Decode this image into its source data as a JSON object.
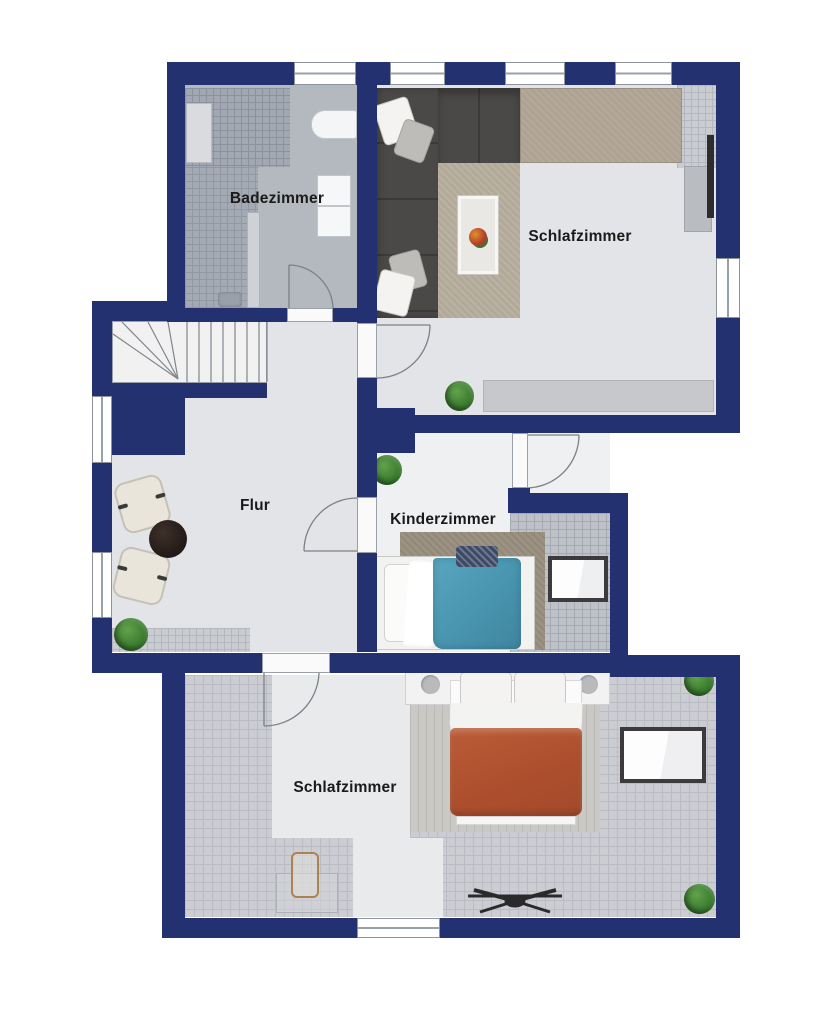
{
  "floorplan": {
    "title": "Obergeschoss Grundriss",
    "rooms": [
      {
        "id": "badezimmer",
        "label": "Badezimmer"
      },
      {
        "id": "schlafzimmer-top",
        "label": "Schlafzimmer"
      },
      {
        "id": "flur",
        "label": "Flur"
      },
      {
        "id": "kinderzimmer",
        "label": "Kinderzimmer"
      },
      {
        "id": "schlafzimmer-bottom",
        "label": "Schlafzimmer"
      }
    ],
    "colors": {
      "wall": "#243170",
      "floor_light": "#e2e4e7",
      "tile_light": "#cccdd2",
      "tile_shower": "#a2a8b2",
      "rug_beige": "#b2a998",
      "rug_brown": "#9c9282",
      "rug_gray": "#cac9c5",
      "duvet_teal": "#4d9cb8",
      "duvet_terracotta": "#b0532f",
      "sofa_gray": "#4b4947",
      "plant_green": "#3f7d33"
    },
    "counts": {
      "windows": 8,
      "doors": 5,
      "skylights": 2,
      "plants": 5
    },
    "furniture": [
      "corner-sofa",
      "coffee-tray",
      "wardrobe",
      "tv",
      "media-console",
      "bathtub",
      "double-vanity",
      "shower",
      "toilet",
      "staircase",
      "armchair",
      "armchair",
      "round-coffee-table",
      "single-bed-teal",
      "double-bed-terracotta",
      "nightstand",
      "nightstand",
      "skylight",
      "skylight",
      "ceiling-fan",
      "desk",
      "chair",
      "plant",
      "plant",
      "plant",
      "plant",
      "plant"
    ]
  }
}
